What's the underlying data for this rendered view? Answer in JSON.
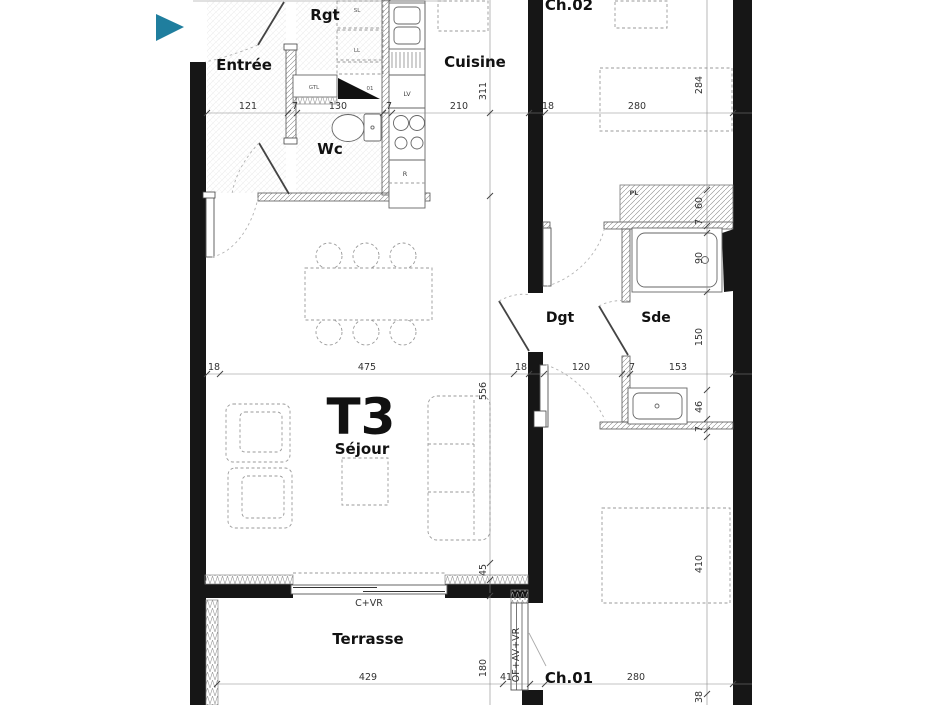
{
  "viewer": {
    "accent_color": "#1f7e9e"
  },
  "plan": {
    "unit_label": "T3",
    "rooms": {
      "entree": "Entrée",
      "rgt": "Rgt",
      "wc": "Wc",
      "cuisine": "Cuisine",
      "ch02": "Ch.02",
      "dgt": "Dgt",
      "sde": "Sde",
      "sejour": "Séjour",
      "terrasse": "Terrasse",
      "ch01": "Ch.01"
    },
    "labels": {
      "gtl": "GTL",
      "sl": "SL",
      "ll": "LL",
      "lv": "LV",
      "fridge": "R",
      "placard": "PL",
      "door_number": "01",
      "window_sejour": "C+VR",
      "window_ch01": "OF+AV+VR"
    },
    "dims": {
      "top": [
        "121",
        "7",
        "130",
        "7",
        "210",
        "18",
        "280"
      ],
      "mid": [
        "18",
        "475",
        "18",
        "120",
        "7",
        "153"
      ],
      "bottom": [
        "429",
        "41",
        "280"
      ],
      "left": [
        "311",
        "556",
        "45",
        "180"
      ],
      "right": [
        "284",
        "60",
        "7",
        "90",
        "150",
        "46",
        "7",
        "410",
        "38"
      ]
    }
  }
}
